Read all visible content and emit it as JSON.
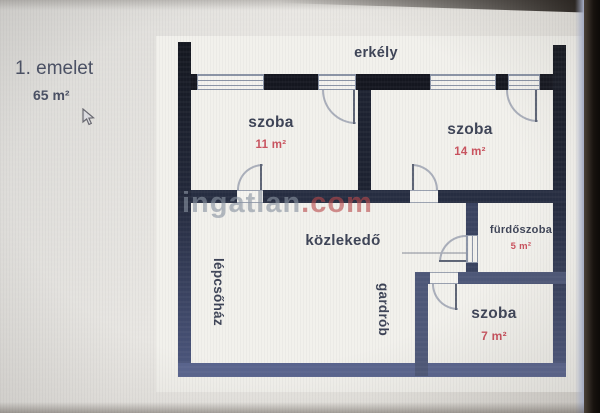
{
  "header": {
    "floor_label": "1. emelet",
    "floor_area": "65 m²"
  },
  "watermark": {
    "name": "ingatlan",
    "tld": ".com"
  },
  "rooms": {
    "erkely": {
      "label": "erkély"
    },
    "szoba_11": {
      "label": "szoba",
      "area": "11 m²"
    },
    "szoba_14": {
      "label": "szoba",
      "area": "14 m²"
    },
    "kozlekedo": {
      "label": "közlekedő"
    },
    "furdoszoba": {
      "label": "fürdőszoba",
      "area": "5 m²"
    },
    "szoba_7": {
      "label": "szoba",
      "area": "7 m²"
    },
    "lepcsohaz": {
      "label": "lépcsőház"
    },
    "gardrob": {
      "label": "gardrób"
    }
  },
  "colors": {
    "area_accent": "#c9505c",
    "label_text": "#3c4255",
    "wall_dark": "#14161f",
    "wall_slate": "#59648e",
    "watermark_gray": "#8791a0",
    "watermark_red": "#b94648"
  }
}
